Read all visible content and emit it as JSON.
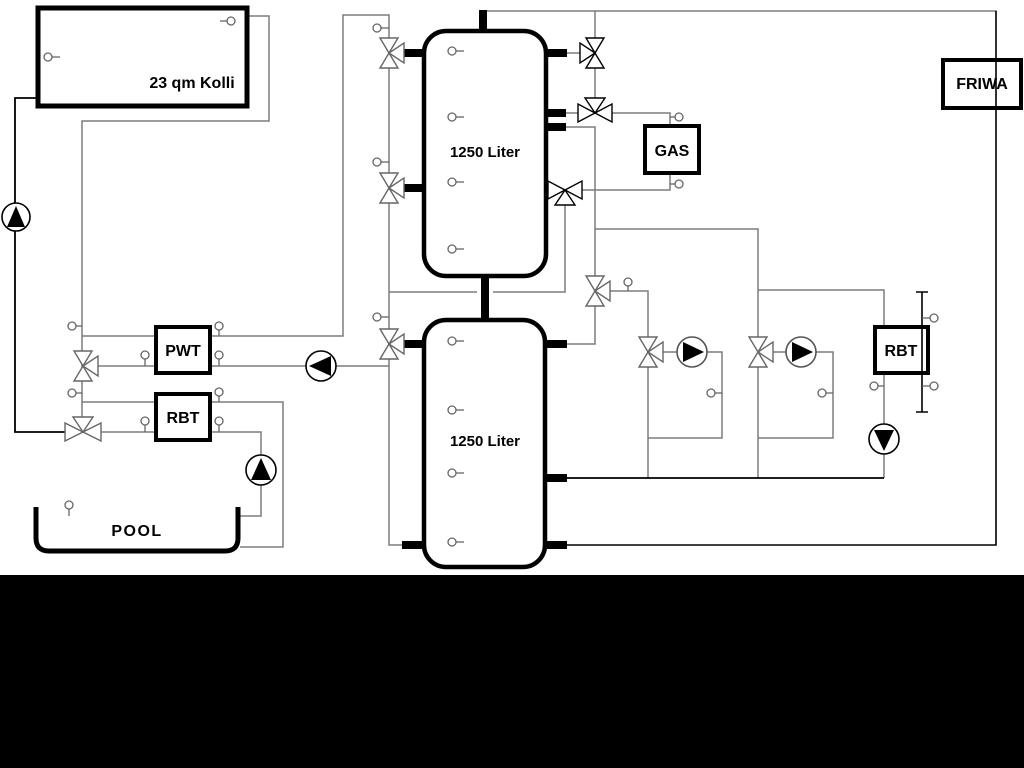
{
  "diagram": {
    "background": "#ffffff",
    "bottom_bar_color": "#000000",
    "pipe_color_gray": "#7d7d7d",
    "pipe_color_black": "#000000",
    "labels": {
      "collector": "23 qm Kolli",
      "tank_top": "1250 Liter",
      "tank_bottom": "1250 Liter",
      "pwt": "PWT",
      "rbt_left": "RBT",
      "gas": "GAS",
      "friwa": "FRIWA",
      "rbt_right": "RBT",
      "pool": "POOL"
    }
  }
}
